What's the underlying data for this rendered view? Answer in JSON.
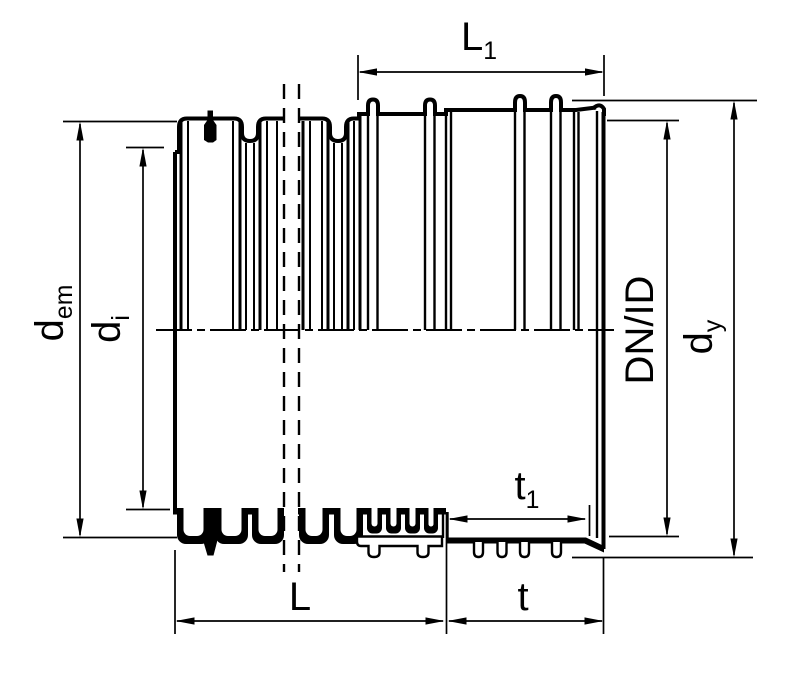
{
  "drawing": {
    "type": "technical-drawing-corrugated-pipe",
    "background_color": "#ffffff",
    "line_color": "#000000",
    "labels": {
      "L1": {
        "base": "L",
        "sub": "1"
      },
      "dem": {
        "base": "d",
        "sub": "em"
      },
      "di": {
        "base": "d",
        "sub": "i"
      },
      "dn_id": {
        "base": "DN/ID",
        "sub": ""
      },
      "dy": {
        "base": "d",
        "sub": "y"
      },
      "t1": {
        "base": "t",
        "sub": "1"
      },
      "L": {
        "base": "L",
        "sub": ""
      },
      "t": {
        "base": "t",
        "sub": ""
      }
    }
  }
}
